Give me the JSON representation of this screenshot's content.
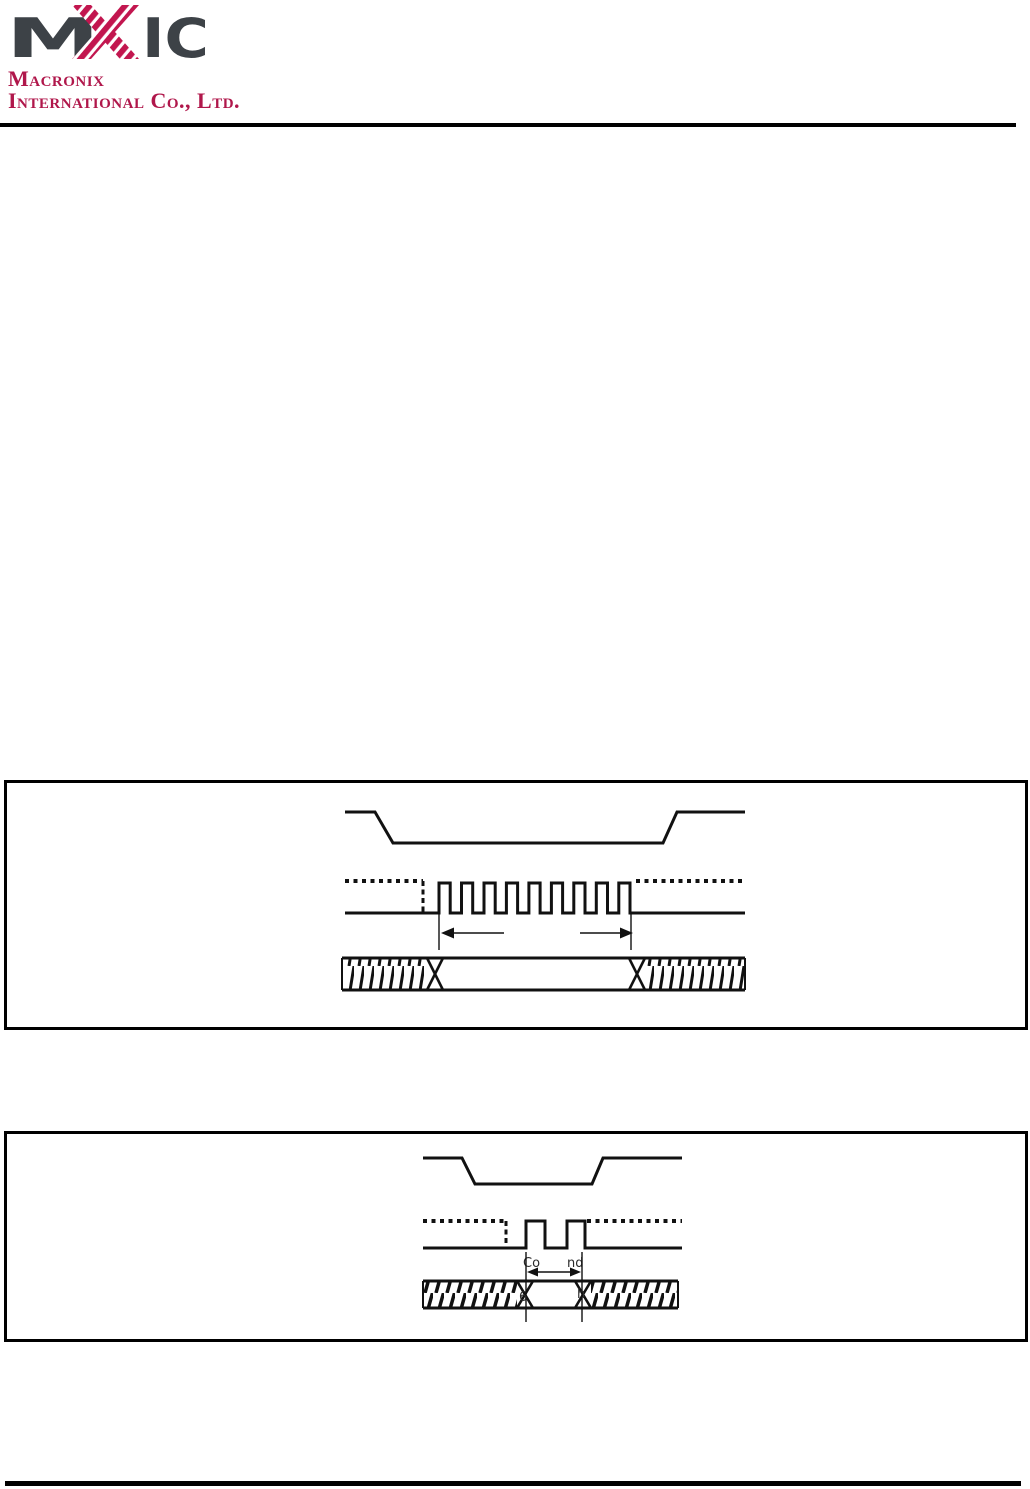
{
  "page": {
    "background": "#ffffff",
    "rule_color": "#000000"
  },
  "header": {
    "logo": {
      "m": "M",
      "x_initial": "X",
      "ic": "IC",
      "dark_color": "#3d4247",
      "brand_color": "#c2164f"
    },
    "company_line1": "Macronix",
    "company_line2": "International Co., Ltd.",
    "text_color": "#b0174b"
  },
  "figure1": {
    "name": "timing-diagram-clock-burst",
    "clock_pulse_count": 9,
    "paths": {
      "cs": "341,32 371,32 389,63 659,63 673,32 741,32",
      "clock_dotted_left": "M341 101 H419",
      "clock_dotted_right": "M632 101 H741",
      "clock_dash_vertical": "M419 101 V133",
      "clock_solid": "M341 133 H435 V103 H446.2 V133 H457.5 V103 H468.7 V133 H480 V103 H491.2 V133 H502.4 V103 H513.6 V133 H524.9 V103 H536.1 V133 H547.4 V103 H558.6 V133 H569.8 V103 H581 V133 H592.3 V103 H603.5 V133 H614.8 V103 H626 V133 H741",
      "tick_left": "M435 133 V170",
      "tick_right": "M627 133 V170",
      "arrow_left_line": "M449 153 H500",
      "arrow_left_head": "437,153 450,147.5 450,158.5",
      "arrow_right_line": "M576 153 H617",
      "arrow_right_head": "629,153 616,147.5 616,158.5",
      "bus_top": "M338 178 H741",
      "bus_bottom": "M338 210 H741",
      "bus_caps": "M338 178 V210 M741 178 V210",
      "bus_cross_left": "M423 178 L439 210 M439 178 L423 210",
      "bus_cross_right": "M625 178 L641 210 M641 178 L625 210"
    }
  },
  "figure2": {
    "name": "timing-diagram-command",
    "clock_pulse_count": 2,
    "labels": {
      "command_fragment_left": "Co",
      "command_fragment_right": "nd",
      "bus_fragment_left": "6",
      "bus_fragment_right": "h"
    },
    "paths": {
      "cs": "419,27 458,27 471,53 588,53 599,27 678,27",
      "clock_dotted_left": "M419 90 H502",
      "clock_dotted_right": "M583 90 H678",
      "clock_dash_vertical": "M502 90 V117",
      "clock_solid": "M419 117 H522 V90 H541 V117 H563 V90 H581 V117 H678",
      "tick_left": "M522 121 V191",
      "tick_right": "M578 121 V191",
      "arrow_line": "M532 141 H568",
      "arrow_left_head": "523,141 534,136.5 534,145.5",
      "arrow_right_head": "577,141 566,136.5 566,145.5",
      "bus_top": "M419 150 H674",
      "bus_bottom": "M419 177 H674",
      "bus_caps": "M419 150 V177 M674 150 V177",
      "bus_cross_left": "M513 150 L529 177 M529 150 L513 177",
      "bus_cross_right": "M571 150 L587 177 M587 150 L571 177"
    }
  }
}
